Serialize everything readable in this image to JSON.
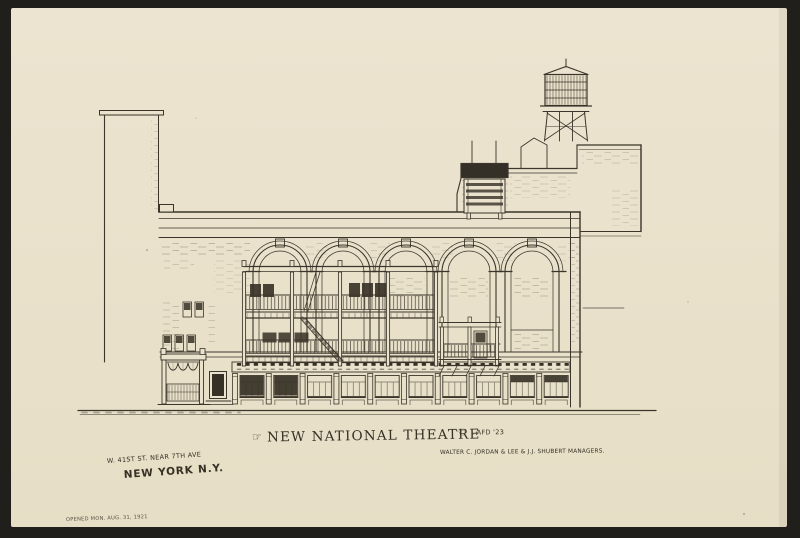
{
  "artwork": {
    "title": "NEW NATIONAL THEATRE",
    "flourish_left": "☞",
    "flourish_right": "☜",
    "artist_mark": ". AFD '23",
    "managers_caption": "WALTER C. JORDAN & LEE & J.J. SHUBERT  MANAGERS.",
    "address_line1": "W. 41ST ST. NEAR 7TH AVE",
    "address_line2": "NEW YORK N.Y.",
    "opened_note": "OPENED MON. AUG. 31, 1921",
    "building_sign": "NATIONAL"
  },
  "colors": {
    "backing": "#201f1c",
    "paper": "#eae2cc",
    "ink": "#363025"
  }
}
